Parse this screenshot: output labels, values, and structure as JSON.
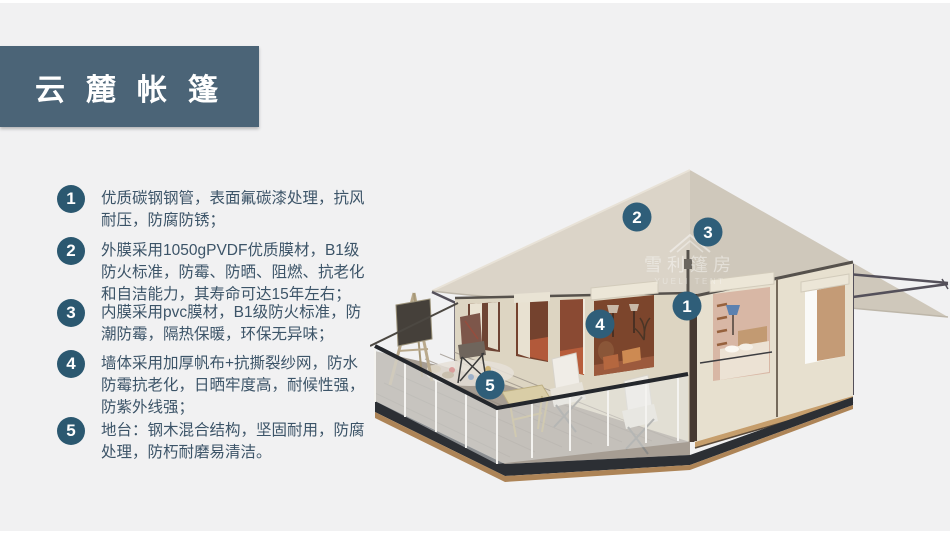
{
  "header": {
    "title": "云麓帐篷",
    "banner_color": "#4b6477"
  },
  "features": [
    {
      "num": "1",
      "text": "优质碳钢钢管，表面氟碳漆处理，抗风耐压，防腐防锈；"
    },
    {
      "num": "2",
      "text": "外膜采用1050gPVDF优质膜材，B1级防火标准，防霉、防晒、阻燃、抗老化和自洁能力，其寿命可达15年左右；"
    },
    {
      "num": "3",
      "text": "内膜采用pvc膜材，B1级防火标准，防潮防霉，隔热保暖，环保无异味；"
    },
    {
      "num": "4",
      "text": "墙体采用加厚帆布+抗撕裂纱网，防水防霉抗老化，日晒牢度高，耐候性强，防紫外线强；"
    },
    {
      "num": "5",
      "text": "地台：钢木混合结构，坚固耐用，防腐处理，防朽耐磨易清洁。"
    }
  ],
  "tent": {
    "marker_color": "#2f5e79",
    "markers": [
      {
        "label": "1",
        "x": 317,
        "y": 151
      },
      {
        "label": "2",
        "x": 267,
        "y": 62
      },
      {
        "label": "3",
        "x": 338,
        "y": 77
      },
      {
        "label": "4",
        "x": 230,
        "y": 169
      },
      {
        "label": "5",
        "x": 120,
        "y": 230
      }
    ],
    "watermark": {
      "cn": "雪利篷房",
      "en": "YUELI TENT"
    }
  },
  "colors": {
    "background": "#f1f1f2",
    "accent": "#4b6477",
    "badge": "#2b5870",
    "text": "#3c5468"
  }
}
